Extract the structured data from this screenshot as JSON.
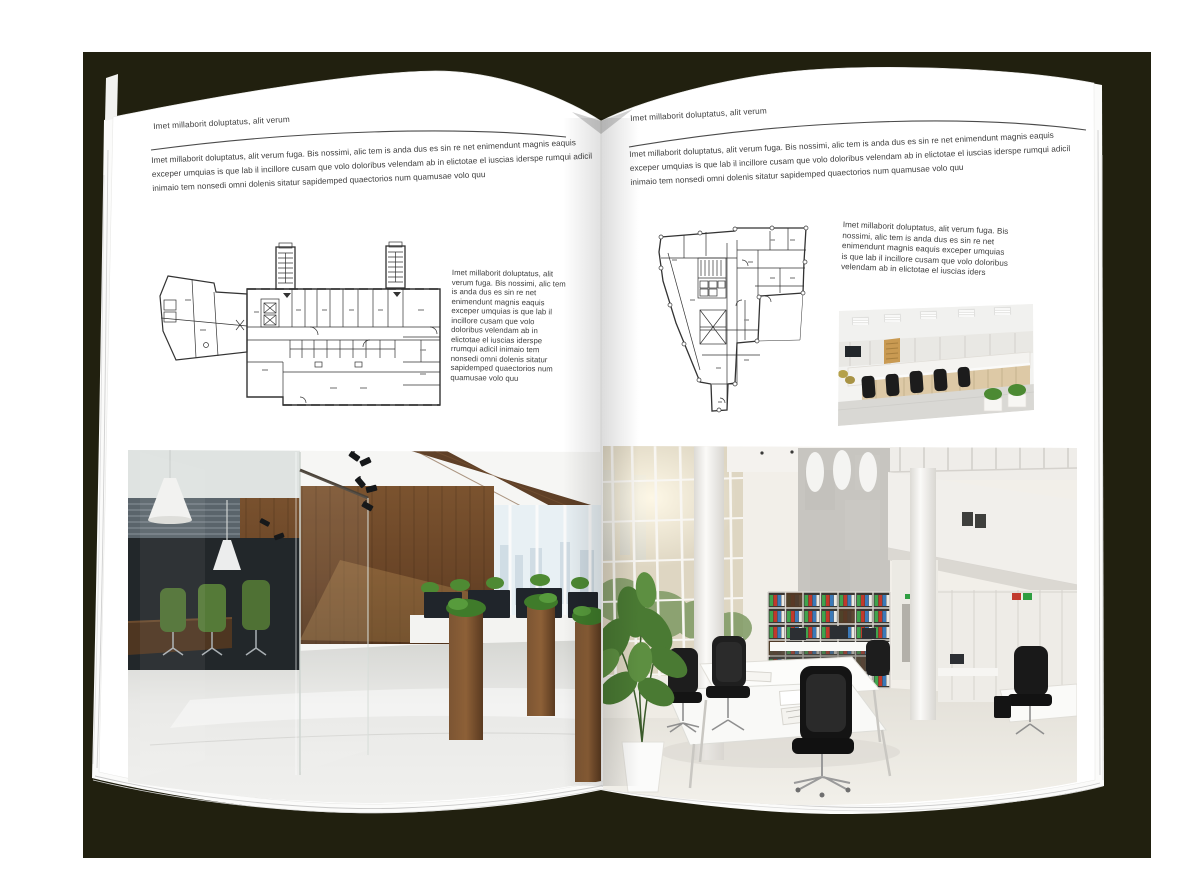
{
  "backdrop": {
    "color": "#21200f",
    "paper_color": "#ffffff",
    "text_color": "#3c3c3c"
  },
  "spread": {
    "left_page": {
      "header": "Imet millaborit doluptatus, alit verum",
      "intro": "Imet millaborit doluptatus, alit verum fuga. Bis nossimi, alic tem is anda dus es sin re net enimendunt magnis eaquis exceper umquias is que lab il incillore cusam que volo doloribus velendam ab in elictotae el iuscias iderspe rumqui adicil inimaio tem nonsedi omni dolenis sitatur sapidemped quaectorios num quamusae volo quu",
      "side_text": "Imet millaborit doluptatus, alit verum fuga. Bis nossimi, alic tem is anda dus es sin re net enimendunt magnis eaquis exceper umquias is que lab il incillore cusam que volo doloribus velendam ab in elictotae el iuscias iderspe rrumqui adicil inimaio tem nonsedi omni dolenis sitatur sapidemped quaectorios num quamusae volo quu"
    },
    "right_page": {
      "header": "Imet millaborit doluptatus, alit verum",
      "intro": "Imet millaborit doluptatus, alit verum fuga. Bis nossimi, alic tem is anda dus es sin re net enimendunt magnis eaquis exceper umquias is que lab il incillore cusam que volo doloribus velendam ab in elictotae el iuscias iderspe rumqui adicil inimaio tem nonsedi omni dolenis sitatur sapidemped quaectorios num quamusae volo quu",
      "side_text": "Imet millaborit doluptatus, alit verum fuga. Bis nossimi, alic tem is anda dus es sin re net enimendunt magnis eaquis exceper umquias is que lab il incillore cusam que volo doloribus velendam ab in elictotae el iuscias iders"
    }
  }
}
